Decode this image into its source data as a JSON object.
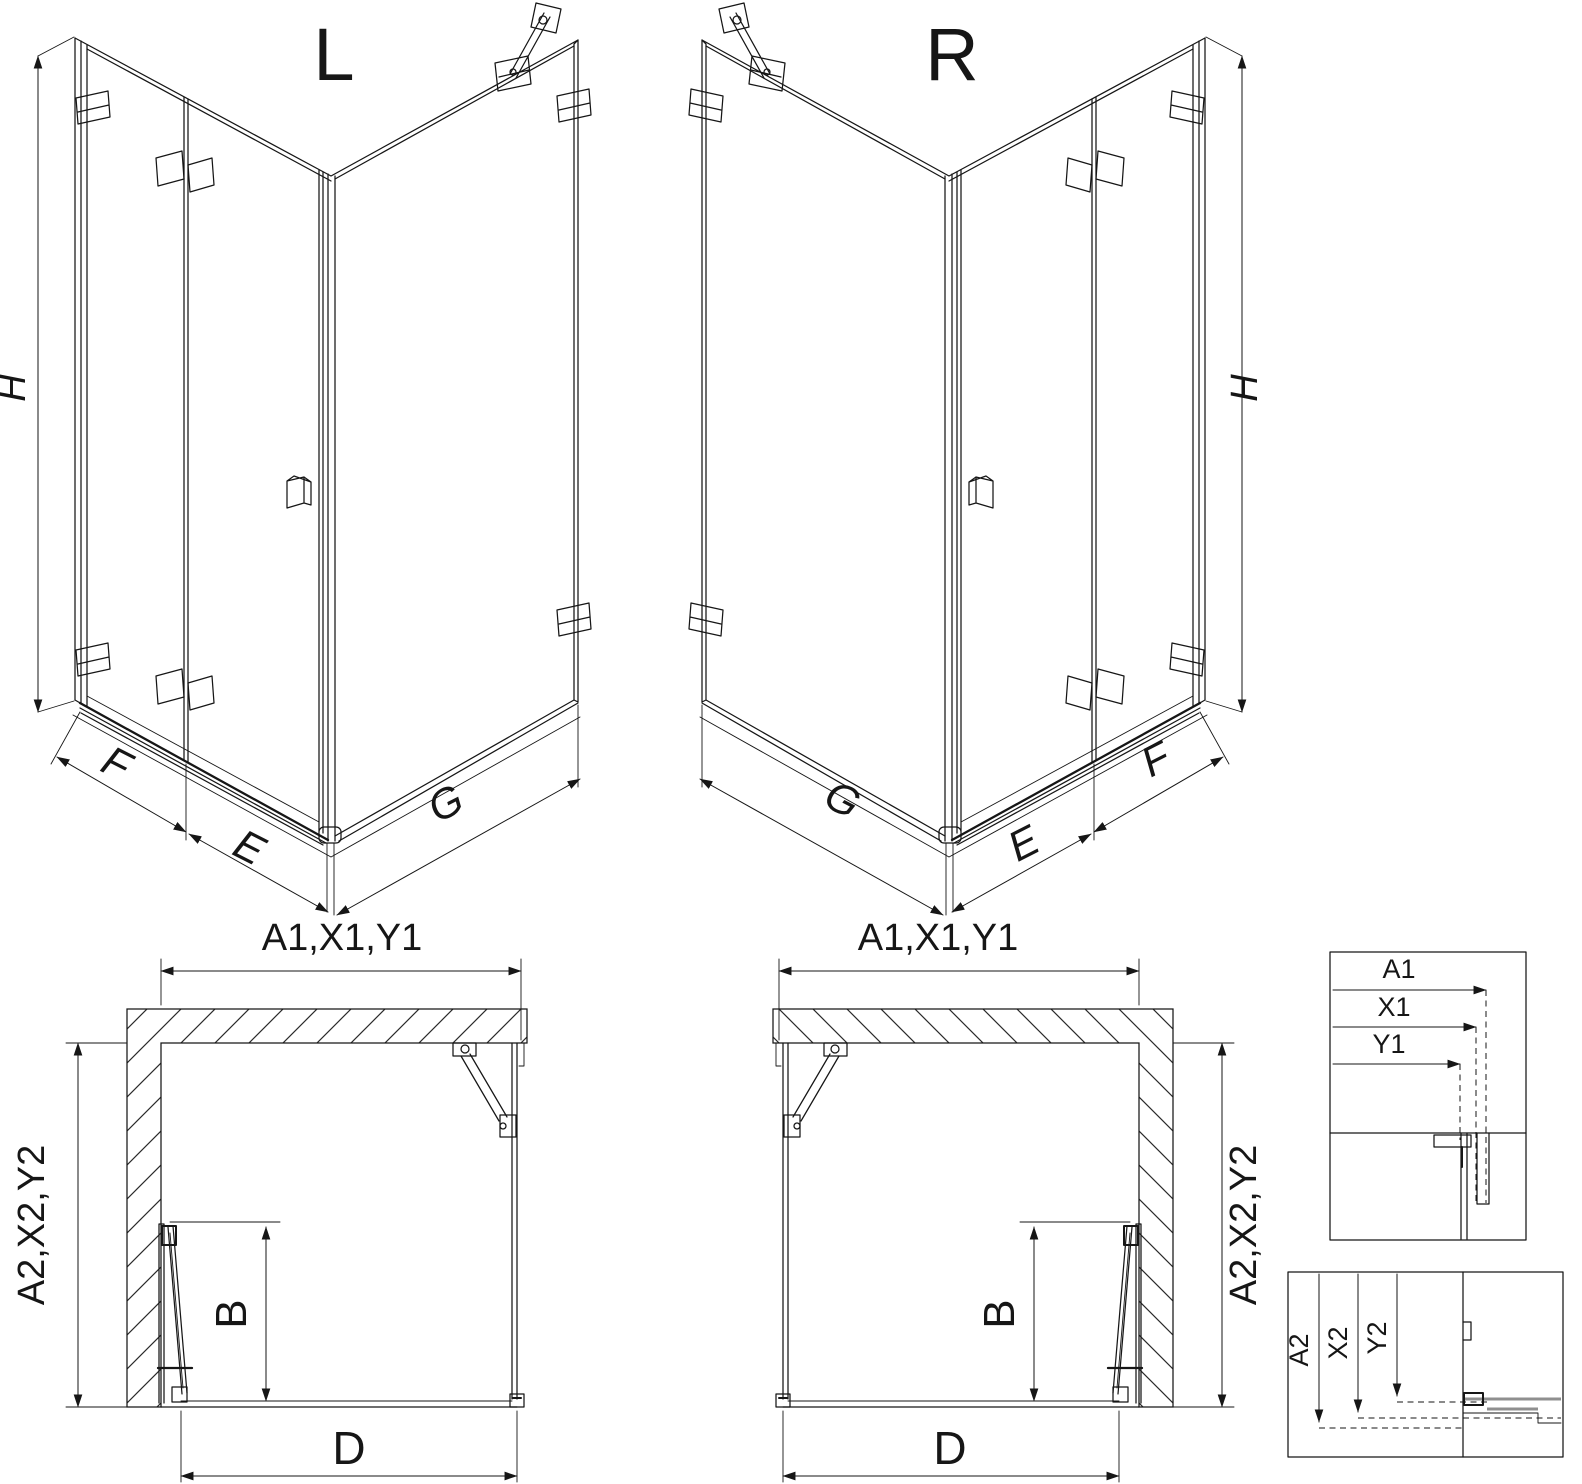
{
  "colors": {
    "line": "#161616",
    "background": "#ffffff"
  },
  "diagram": {
    "iso_left": {
      "title": "L",
      "height": "H",
      "front_fixed": "F",
      "door": "E",
      "side_fixed": "G"
    },
    "iso_right": {
      "title": "R",
      "height": "H",
      "front_fixed": "F",
      "door": "E",
      "side_fixed": "G"
    },
    "plan_left": {
      "width": "A1,X1,Y1",
      "depth": "A2,X2,Y2",
      "door_width": "B",
      "entry": "D"
    },
    "plan_right": {
      "width": "A1,X1,Y1",
      "depth": "A2,X2,Y2",
      "door_width": "B",
      "entry": "D"
    },
    "detail_width": {
      "a": "A1",
      "x": "X1",
      "y": "Y1"
    },
    "detail_depth": {
      "a": "A2",
      "x": "X2",
      "y": "Y2"
    }
  }
}
